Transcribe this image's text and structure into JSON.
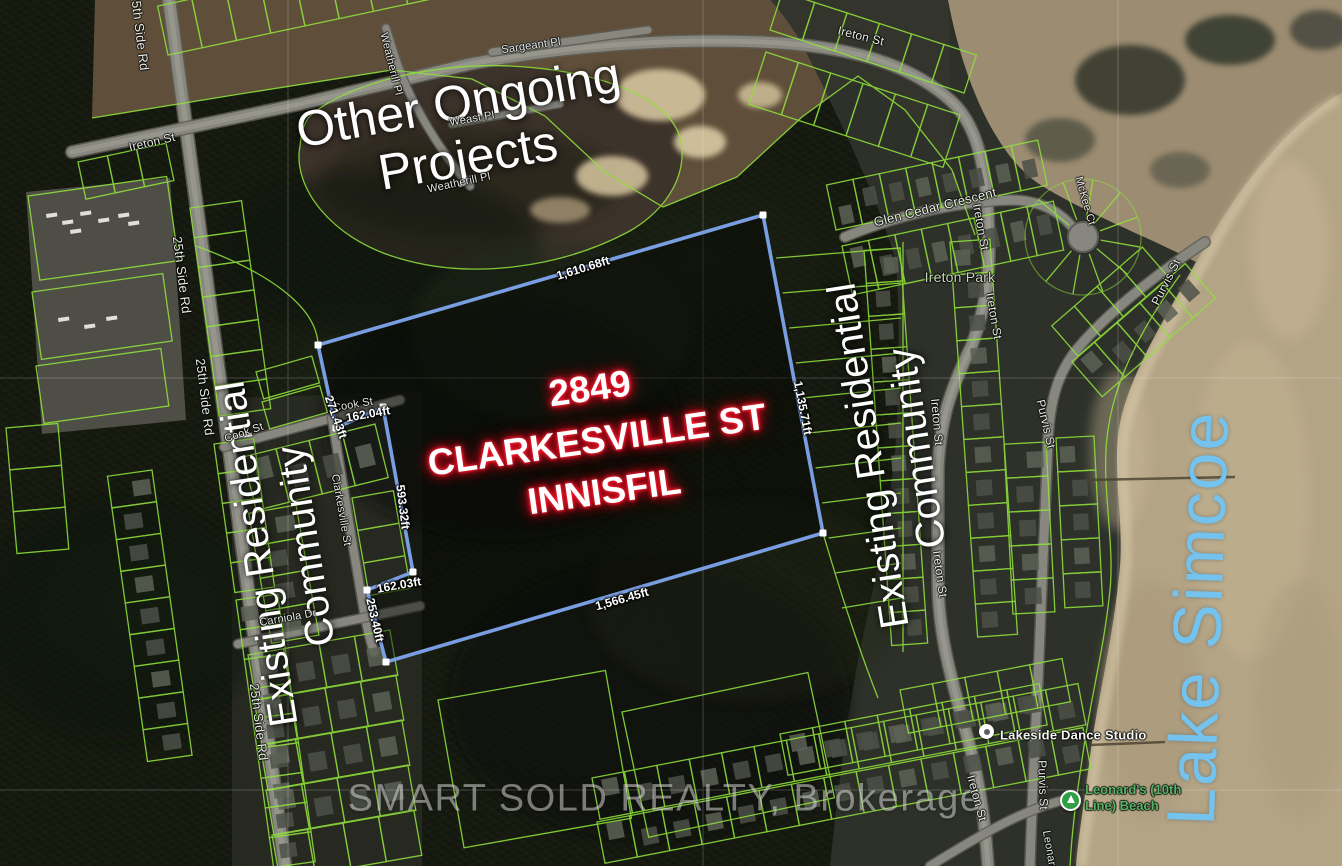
{
  "annotations": {
    "other_projects_line1": "Other Ongoing",
    "other_projects_line2": "Projects",
    "property_line1": "2849",
    "property_line2": "CLARKESVILLE ST",
    "property_line3": "INNISFIL",
    "community_left_line1": "Existing Residential",
    "community_left_line2": "Community",
    "community_right_line1": "Existing Residential",
    "community_right_line2": "Community",
    "lake_name": "Lake Simcoe",
    "watermark": "SMART SOLD REALTY, Brokerage"
  },
  "pois": {
    "park": "Ireton Park",
    "dance_studio": "Lakeside Dance Studio",
    "beach_line1": "Leonard's (10th",
    "beach_line2": "Line) Beach"
  },
  "boundary_measurements": [
    {
      "text": "1,610.68ft",
      "x": 583,
      "y": 268,
      "rot": -17
    },
    {
      "text": "1,135.71ft",
      "x": 803,
      "y": 408,
      "rot": 79
    },
    {
      "text": "1,566.45ft",
      "x": 622,
      "y": 599,
      "rot": -16
    },
    {
      "text": "271.43ft",
      "x": 336,
      "y": 417,
      "rot": 70
    },
    {
      "text": "162.04ft",
      "x": 368,
      "y": 414,
      "rot": -10
    },
    {
      "text": "593.32ft",
      "x": 403,
      "y": 507,
      "rot": 83
    },
    {
      "text": "162.03ft",
      "x": 399,
      "y": 585,
      "rot": -10
    },
    {
      "text": "253.40ft",
      "x": 375,
      "y": 620,
      "rot": 77
    }
  ],
  "street_labels": [
    {
      "name": "25th Side Rd",
      "x": 140,
      "y": 32,
      "rot": 83,
      "size": 13
    },
    {
      "name": "Ireton St",
      "x": 152,
      "y": 142,
      "rot": -13,
      "size": 12
    },
    {
      "name": "Weatherill Pl",
      "x": 391,
      "y": 64,
      "rot": 76,
      "size": 11
    },
    {
      "name": "Sargeant Pl",
      "x": 531,
      "y": 46,
      "rot": -8,
      "size": 11
    },
    {
      "name": "Weast Pl",
      "x": 472,
      "y": 119,
      "rot": -10,
      "size": 11
    },
    {
      "name": "Weatherill Pl",
      "x": 459,
      "y": 183,
      "rot": -12,
      "size": 11
    },
    {
      "name": "Ireton St",
      "x": 861,
      "y": 36,
      "rot": 14,
      "size": 12
    },
    {
      "name": "25th Side Rd",
      "x": 182,
      "y": 275,
      "rot": 83,
      "size": 13
    },
    {
      "name": "25th Side Rd",
      "x": 205,
      "y": 397,
      "rot": 83,
      "size": 13
    },
    {
      "name": "25th Side Rd",
      "x": 259,
      "y": 722,
      "rot": 83,
      "size": 13
    },
    {
      "name": "Glen Cedar Crescent",
      "x": 935,
      "y": 207,
      "rot": -14,
      "size": 13
    },
    {
      "name": "McKee Ct",
      "x": 1085,
      "y": 201,
      "rot": 74,
      "size": 11
    },
    {
      "name": "Ireton St",
      "x": 981,
      "y": 227,
      "rot": 80,
      "size": 12
    },
    {
      "name": "Ireton St",
      "x": 994,
      "y": 316,
      "rot": 80,
      "size": 12
    },
    {
      "name": "Purvis St",
      "x": 1166,
      "y": 282,
      "rot": -63,
      "size": 12
    },
    {
      "name": "Purvis St",
      "x": 1046,
      "y": 424,
      "rot": 77,
      "size": 12
    },
    {
      "name": "Ireton St",
      "x": 937,
      "y": 422,
      "rot": 85,
      "size": 12
    },
    {
      "name": "Ireton St",
      "x": 940,
      "y": 574,
      "rot": 82,
      "size": 12
    },
    {
      "name": "Purvis St",
      "x": 1043,
      "y": 785,
      "rot": 88,
      "size": 12
    },
    {
      "name": "Ireton St",
      "x": 977,
      "y": 798,
      "rot": 75,
      "size": 12
    },
    {
      "name": "Cook St",
      "x": 244,
      "y": 433,
      "rot": -19,
      "size": 11
    },
    {
      "name": "Cook St",
      "x": 353,
      "y": 405,
      "rot": -10,
      "size": 11
    },
    {
      "name": "Clarkesville St",
      "x": 341,
      "y": 510,
      "rot": 80,
      "size": 11
    },
    {
      "name": "Carniola Dr",
      "x": 288,
      "y": 618,
      "rot": -10,
      "size": 11
    },
    {
      "name": "Leonards",
      "x": 1050,
      "y": 854,
      "rot": 80,
      "size": 11
    }
  ],
  "colors": {
    "boundary_blue": "#7da2e8",
    "parcel_green": "#90e03c",
    "label_red_glow": "#e81228",
    "lake_text": "#74c3ee",
    "measurement_text": "#ffffff",
    "sand": "#b4a486"
  }
}
